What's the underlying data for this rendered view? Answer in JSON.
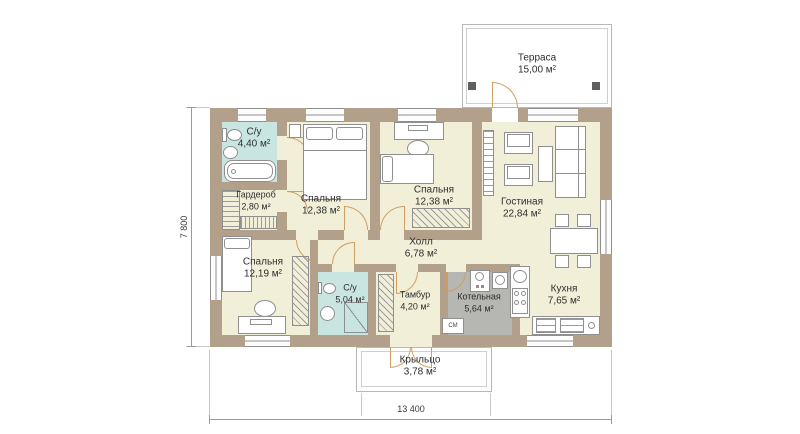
{
  "plan": {
    "dimensions": {
      "width": "13 400",
      "height": "7 800"
    },
    "rooms": [
      {
        "id": "terrace",
        "name": "Терраса",
        "area": "15,00 м²"
      },
      {
        "id": "bathroom1",
        "name": "С/у",
        "area": "4,40 м²"
      },
      {
        "id": "wardrobe",
        "name": "Гардероб",
        "area": "2,80 м²"
      },
      {
        "id": "bedroom1",
        "name": "Спальня",
        "area": "12,38 м²"
      },
      {
        "id": "bedroom2",
        "name": "Спальня",
        "area": "12,38 м²"
      },
      {
        "id": "living",
        "name": "Гостиная",
        "area": "22,84 м²"
      },
      {
        "id": "hall",
        "name": "Холл",
        "area": "6,78 м²"
      },
      {
        "id": "bedroom3",
        "name": "Спальня",
        "area": "12,19 м²"
      },
      {
        "id": "bathroom2",
        "name": "С/у",
        "area": "5,04 м²"
      },
      {
        "id": "vestibule",
        "name": "Тамбур",
        "area": "4,20 м²"
      },
      {
        "id": "boiler",
        "name": "Котельная",
        "area": "5,64 м²"
      },
      {
        "id": "kitchen",
        "name": "Кухня",
        "area": "7,65 м²"
      },
      {
        "id": "porch",
        "name": "Крыльцо",
        "area": "3,78 м²"
      }
    ],
    "appliance_labels": {
      "washing_machine": "СМ"
    },
    "colors": {
      "wall": "#b2a08a",
      "floor": "#f2efd9",
      "wet": "#c9e5e1",
      "boiler": "#b6b7b3",
      "door": "#cf9e63",
      "outline": "#8f8f8f",
      "dim": "#9a9a9a",
      "post": "#5f5f5f",
      "text": "#2e2e2e"
    }
  }
}
